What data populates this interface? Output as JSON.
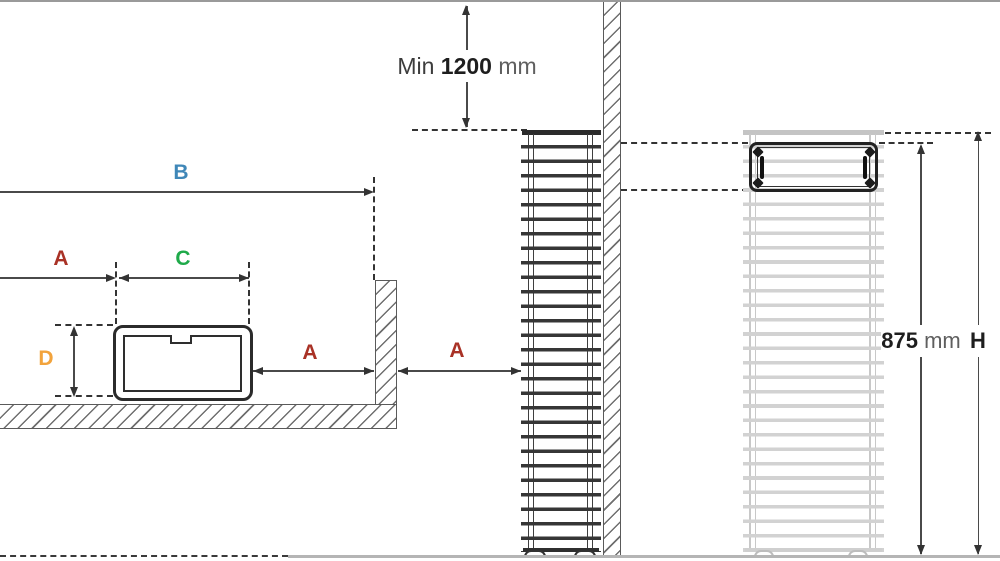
{
  "diagram": {
    "type": "radiator-installation-clearance-diagram",
    "labels": {
      "b": "B",
      "a_left": "A",
      "c": "C",
      "d": "D",
      "a_mid": "A",
      "a_right": "A",
      "h": "H",
      "min_clearance": {
        "prefix": "Min",
        "value": "1200",
        "unit": "mm"
      },
      "mount_height": {
        "value": "875",
        "unit": "mm"
      }
    },
    "colors": {
      "dim_a": "#a93226",
      "dim_b": "#3f87b8",
      "dim_c": "#1faa4a",
      "dim_d": "#f2a33c",
      "ink": "#333333",
      "radiator_gray": "#cccccc",
      "wall_outline": "#5a5a5a"
    }
  }
}
